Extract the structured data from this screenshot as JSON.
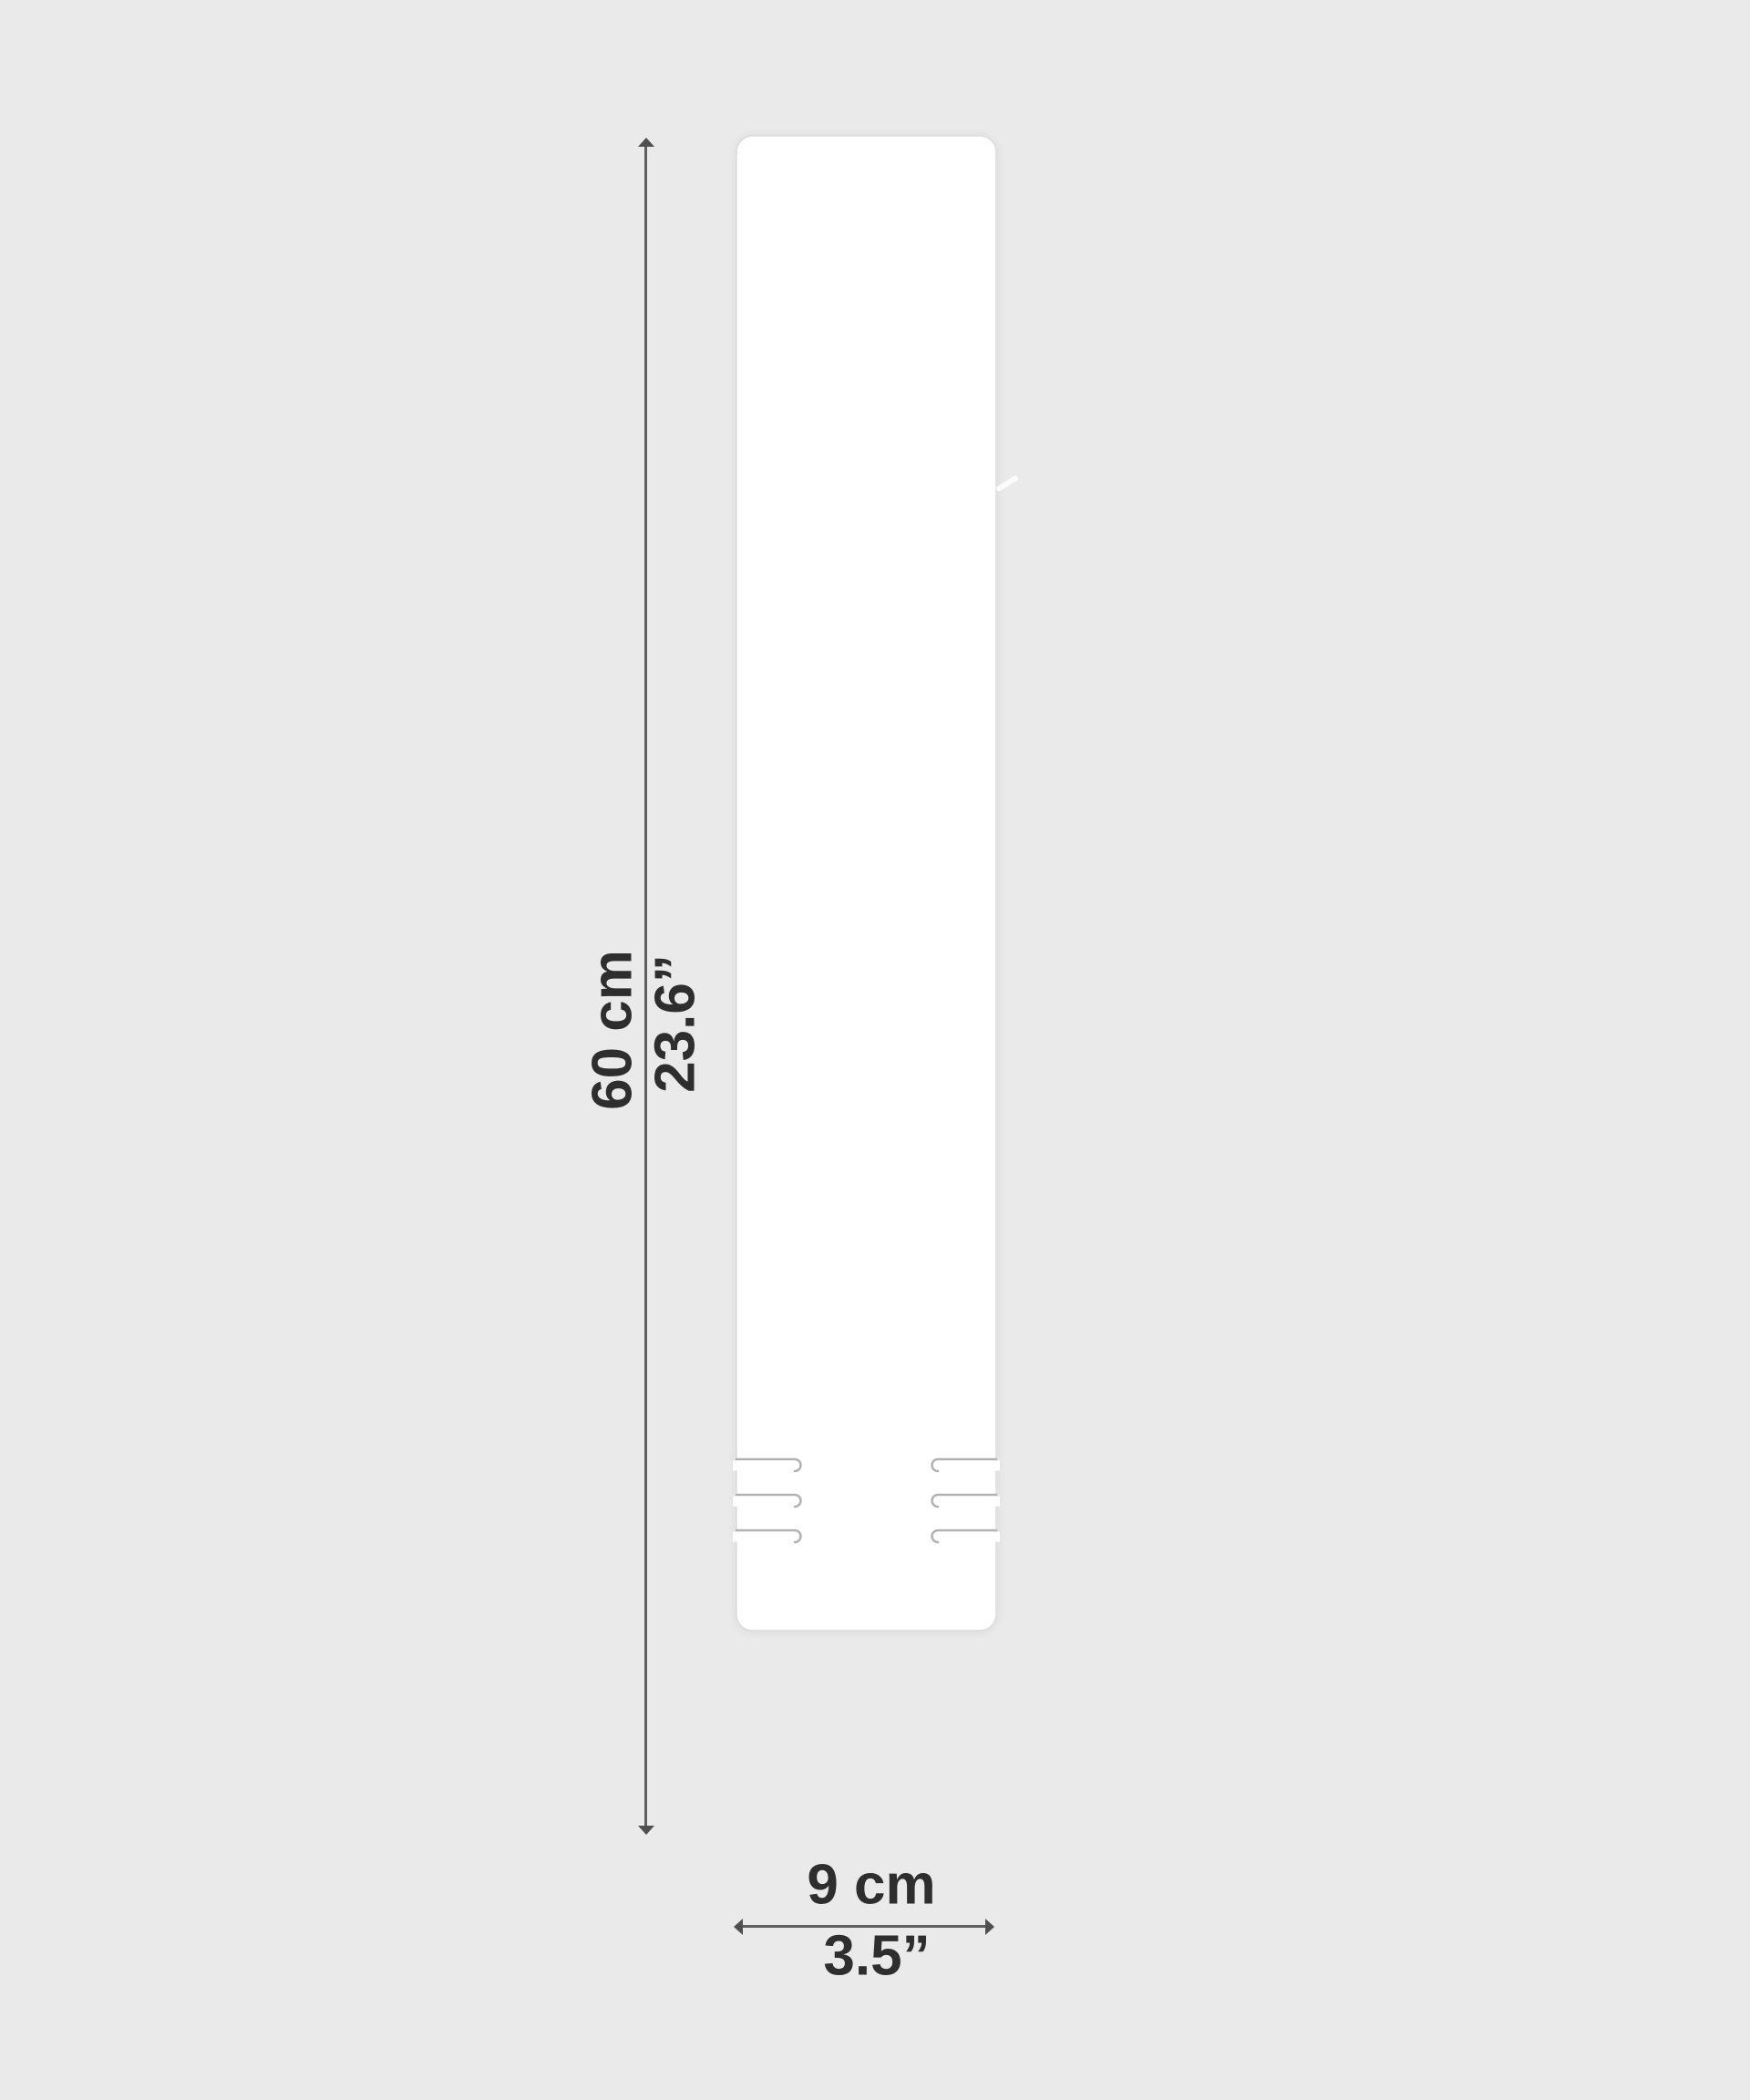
{
  "colors": {
    "background": "#eaeaea",
    "panel": "#ffffff",
    "panel_edge": "#dcdcdc",
    "slit": "#b2b2b2",
    "dimension_line": "#5f5f5f",
    "text": "#2e2e2e"
  },
  "dimensions": {
    "height": {
      "metric": "60 cm",
      "imperial": "23.6”"
    },
    "width": {
      "metric": "9 cm",
      "imperial": "3.5”"
    }
  }
}
